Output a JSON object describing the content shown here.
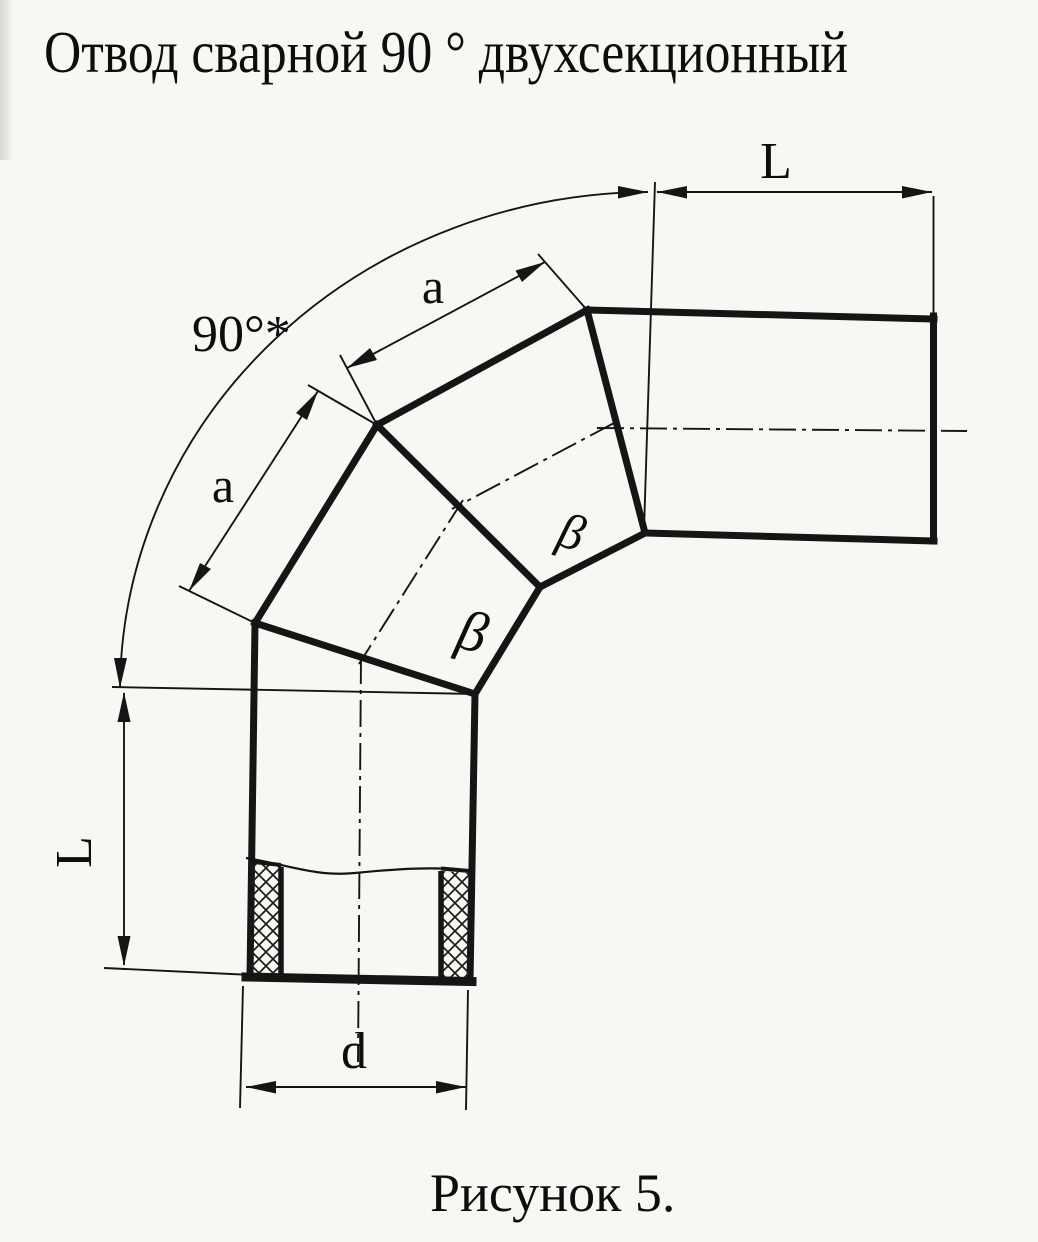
{
  "page": {
    "title": "Отвод сварной 90 ° двухсекционный",
    "caption": "Рисунок 5."
  },
  "figure": {
    "type": "technical-drawing",
    "subject": "welded 90-degree two-section pipe elbow",
    "labels": {
      "angle_arc": "90°*",
      "length_top": "L",
      "length_left": "L",
      "section_edge_upper": "a",
      "section_edge_lower": "a",
      "bevel_angle_upper": "β",
      "bevel_angle_lower": "β",
      "diameter": "d"
    }
  },
  "colors": {
    "ink": "#151515",
    "paper": "#f8f7f3"
  }
}
